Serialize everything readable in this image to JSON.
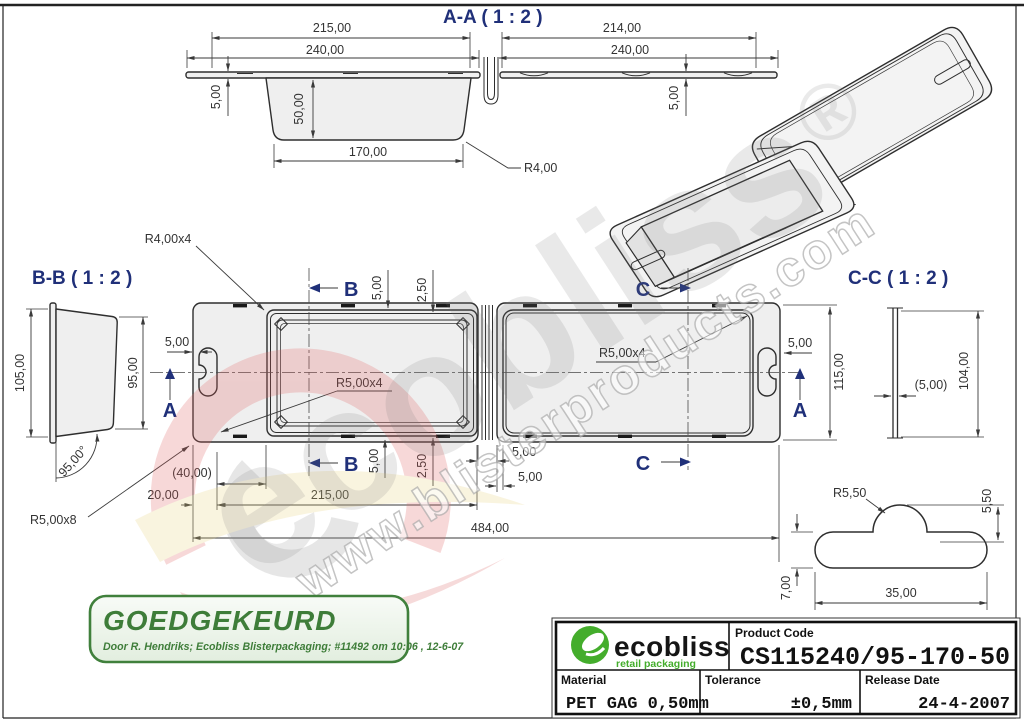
{
  "drawing": {
    "section_aa": {
      "title": "A-A  ( 1 : 2 )",
      "d215": "215,00",
      "d240_left": "240,00",
      "d5_left": "5,00",
      "d50": "50,00",
      "d170": "170,00",
      "r4": "R4,00",
      "d214": "214,00",
      "d240_right": "240,00",
      "d5_right": "5,00"
    },
    "section_bb": {
      "title": "B-B  ( 1 : 2 )",
      "d105": "105,00",
      "d95": "95,00",
      "angle": "95,00°",
      "r5x8": "R5,00x8"
    },
    "section_cc": {
      "title": "C-C  ( 1 : 2 )",
      "d5_paren": "(5,00)",
      "d104": "104,00"
    },
    "plan": {
      "r4x4": "R4,00x4",
      "r5x4_left": "R5,00x4",
      "r5x4_right": "R5,00x4",
      "marker_a_left": "A",
      "marker_a_right": "A",
      "marker_b_top": "B",
      "marker_b_bottom": "B",
      "marker_c_top": "C",
      "marker_c_bottom": "C",
      "d5_slot_left": "5,00",
      "d5_slot_right": "5,00",
      "d115": "115,00",
      "d5_top": "5,00",
      "d250_top": "2,50",
      "d5_bottom": "5,00",
      "d250_bottom": "2,50",
      "d5_hinge_a": "5,00",
      "d5_hinge_b": "5,00",
      "d40": "(40,00)",
      "d20": "20,00",
      "d215": "215,00",
      "d484": "484,00"
    },
    "tab_detail": {
      "r550": "R5,50",
      "d550": "5,50",
      "d700": "7,00",
      "d3500": "35,00"
    }
  },
  "watermark": {
    "brand": "ecobliss",
    "reg": "®",
    "url": "www.blisterproducts.com"
  },
  "stamp": {
    "title": "GOEDGEKEURD",
    "note": "Door R. Hendriks; Ecobliss Blisterpackaging; #11492 om 10:06 , 12-6-07"
  },
  "titleblock": {
    "logo_text": "ecobliss",
    "logo_tagline": "retail packaging",
    "product_code_label": "Product Code",
    "product_code": "CS115240/95-170-50",
    "material_label": "Material",
    "material": "PET GAG 0,50mm",
    "tolerance_label": "Tolerance",
    "tolerance": "±0,5mm",
    "release_label": "Release Date",
    "release": "24-4-2007"
  },
  "colors": {
    "stamp_green": "#3e7d39",
    "logo_green": "#44ad2c",
    "section_label_blue": "#203079",
    "line": "#3a3a3a"
  }
}
